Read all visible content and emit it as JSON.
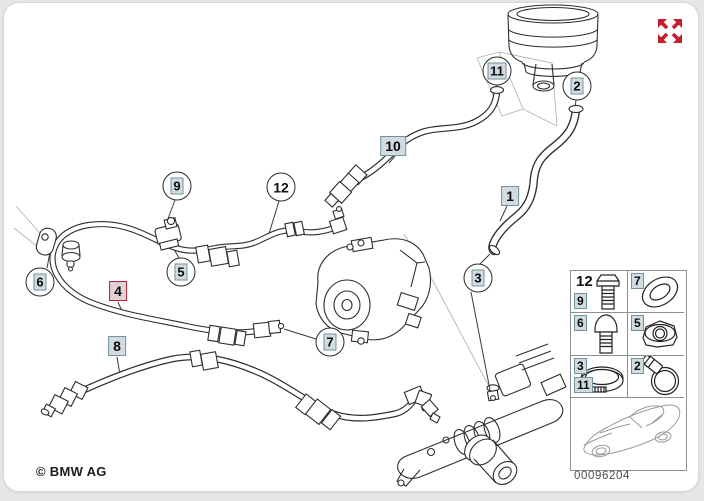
{
  "diagram": {
    "copyright": "© BMW AG",
    "number": "00096204",
    "title": "Power steering hydraulic lines diagram"
  },
  "callouts": [
    {
      "label": "9"
    },
    {
      "label": "12"
    },
    {
      "label": "11"
    },
    {
      "label": "2"
    },
    {
      "label": "10"
    },
    {
      "label": "1"
    },
    {
      "label": "3"
    },
    {
      "label": "5"
    },
    {
      "label": "6"
    },
    {
      "label": "4"
    },
    {
      "label": "8"
    },
    {
      "label": "7"
    }
  ],
  "legend": {
    "cells": [
      {
        "labels": [
          "12",
          "9"
        ],
        "icon": "hex-bolt"
      },
      {
        "labels": [
          "7"
        ],
        "icon": "o-ring"
      },
      {
        "labels": [
          "6"
        ],
        "icon": "shoulder-bolt"
      },
      {
        "labels": [
          "5"
        ],
        "icon": "hex-nut"
      },
      {
        "labels": [
          "3",
          "11"
        ],
        "icon": "band-clamp"
      },
      {
        "labels": [
          "2"
        ],
        "icon": "worm-clamp"
      }
    ],
    "vehicle_thumbnail": "car-silhouette"
  },
  "colors": {
    "highlight_red": "#a32734",
    "hotspot_border": "#71939d",
    "hotspot_fill": "#d2dce0",
    "expand_icon_red": "#c2202f",
    "line": "#2e2e2e"
  }
}
